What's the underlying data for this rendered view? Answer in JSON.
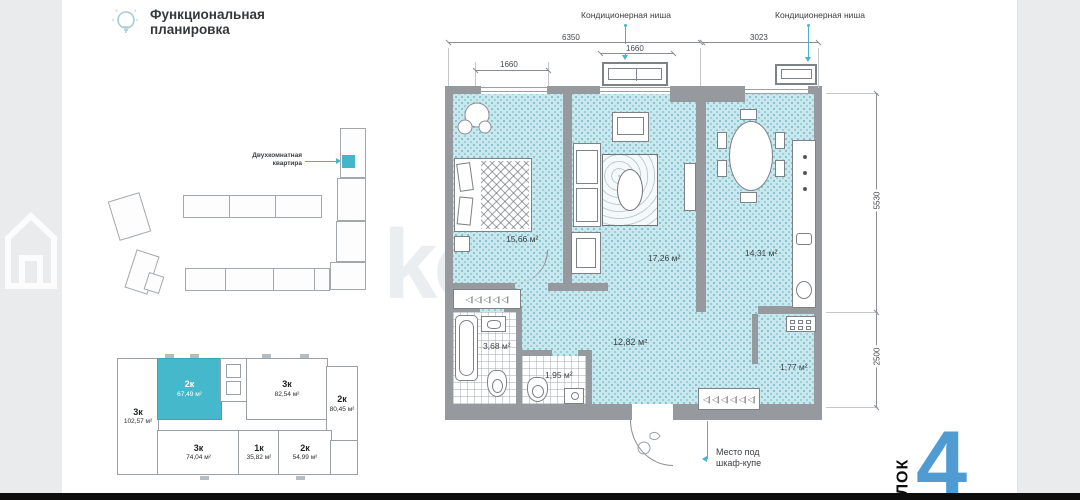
{
  "header": {
    "title_line1": "Функциональная",
    "title_line2": "планировка"
  },
  "site_plan": {
    "callout_line1": "Двухкомнатная",
    "callout_line2": "квартира"
  },
  "floor_schematic": {
    "units": [
      {
        "type": "3к",
        "area": "102,57 м²",
        "highlighted": false
      },
      {
        "type": "2к",
        "area": "67,49 м²",
        "highlighted": true
      },
      {
        "type": "3к",
        "area": "82,54 м²",
        "highlighted": false
      },
      {
        "type": "2к",
        "area": "80,45 м²",
        "highlighted": false
      },
      {
        "type": "3к",
        "area": "74,04 м²",
        "highlighted": false
      },
      {
        "type": "1к",
        "area": "35,82 м²",
        "highlighted": false
      },
      {
        "type": "2к",
        "area": "54,99 м²",
        "highlighted": false
      }
    ]
  },
  "plan": {
    "rooms": [
      {
        "name": "bedroom",
        "area": "15,66 м²"
      },
      {
        "name": "living-room",
        "area": "17,26 м²"
      },
      {
        "name": "kitchen",
        "area": "14,31 м²"
      },
      {
        "name": "bathroom",
        "area": "3,68 м²"
      },
      {
        "name": "wc",
        "area": "1,95 м²"
      },
      {
        "name": "hallway",
        "area": "12,82 м²"
      },
      {
        "name": "niche",
        "area": "1,77 м²"
      }
    ],
    "dimensions": {
      "top_left_total": "6350",
      "top_right_total": "3023",
      "window_left": "1660",
      "window_middle": "1660",
      "right_upper": "5530",
      "right_lower": "2500"
    },
    "annotations": {
      "ac_niche_1": "Кондиционерная ниша",
      "ac_niche_2": "Кондиционерная ниша",
      "wardrobe_note_line1": "Место под",
      "wardrobe_note_line2": "шкаф-купе"
    },
    "wardrobe_symbols_small": "◁| ◁| ◁| ◁| ◁|",
    "wardrobe_symbols_large": "◁| ◁| ◁| ◁| ◁| ◁|"
  },
  "block": {
    "label": "БЛОК",
    "number": "4"
  },
  "watermark": {
    "text": "ko"
  },
  "colors": {
    "accent_teal": "#45b6c9",
    "floor_fill": "#c9e9ef",
    "wall_gray": "#96999d",
    "block_number_blue": "#4f9bd2",
    "background_strip": "#e9ebed",
    "bottom_bar": "#0d0d0d"
  }
}
